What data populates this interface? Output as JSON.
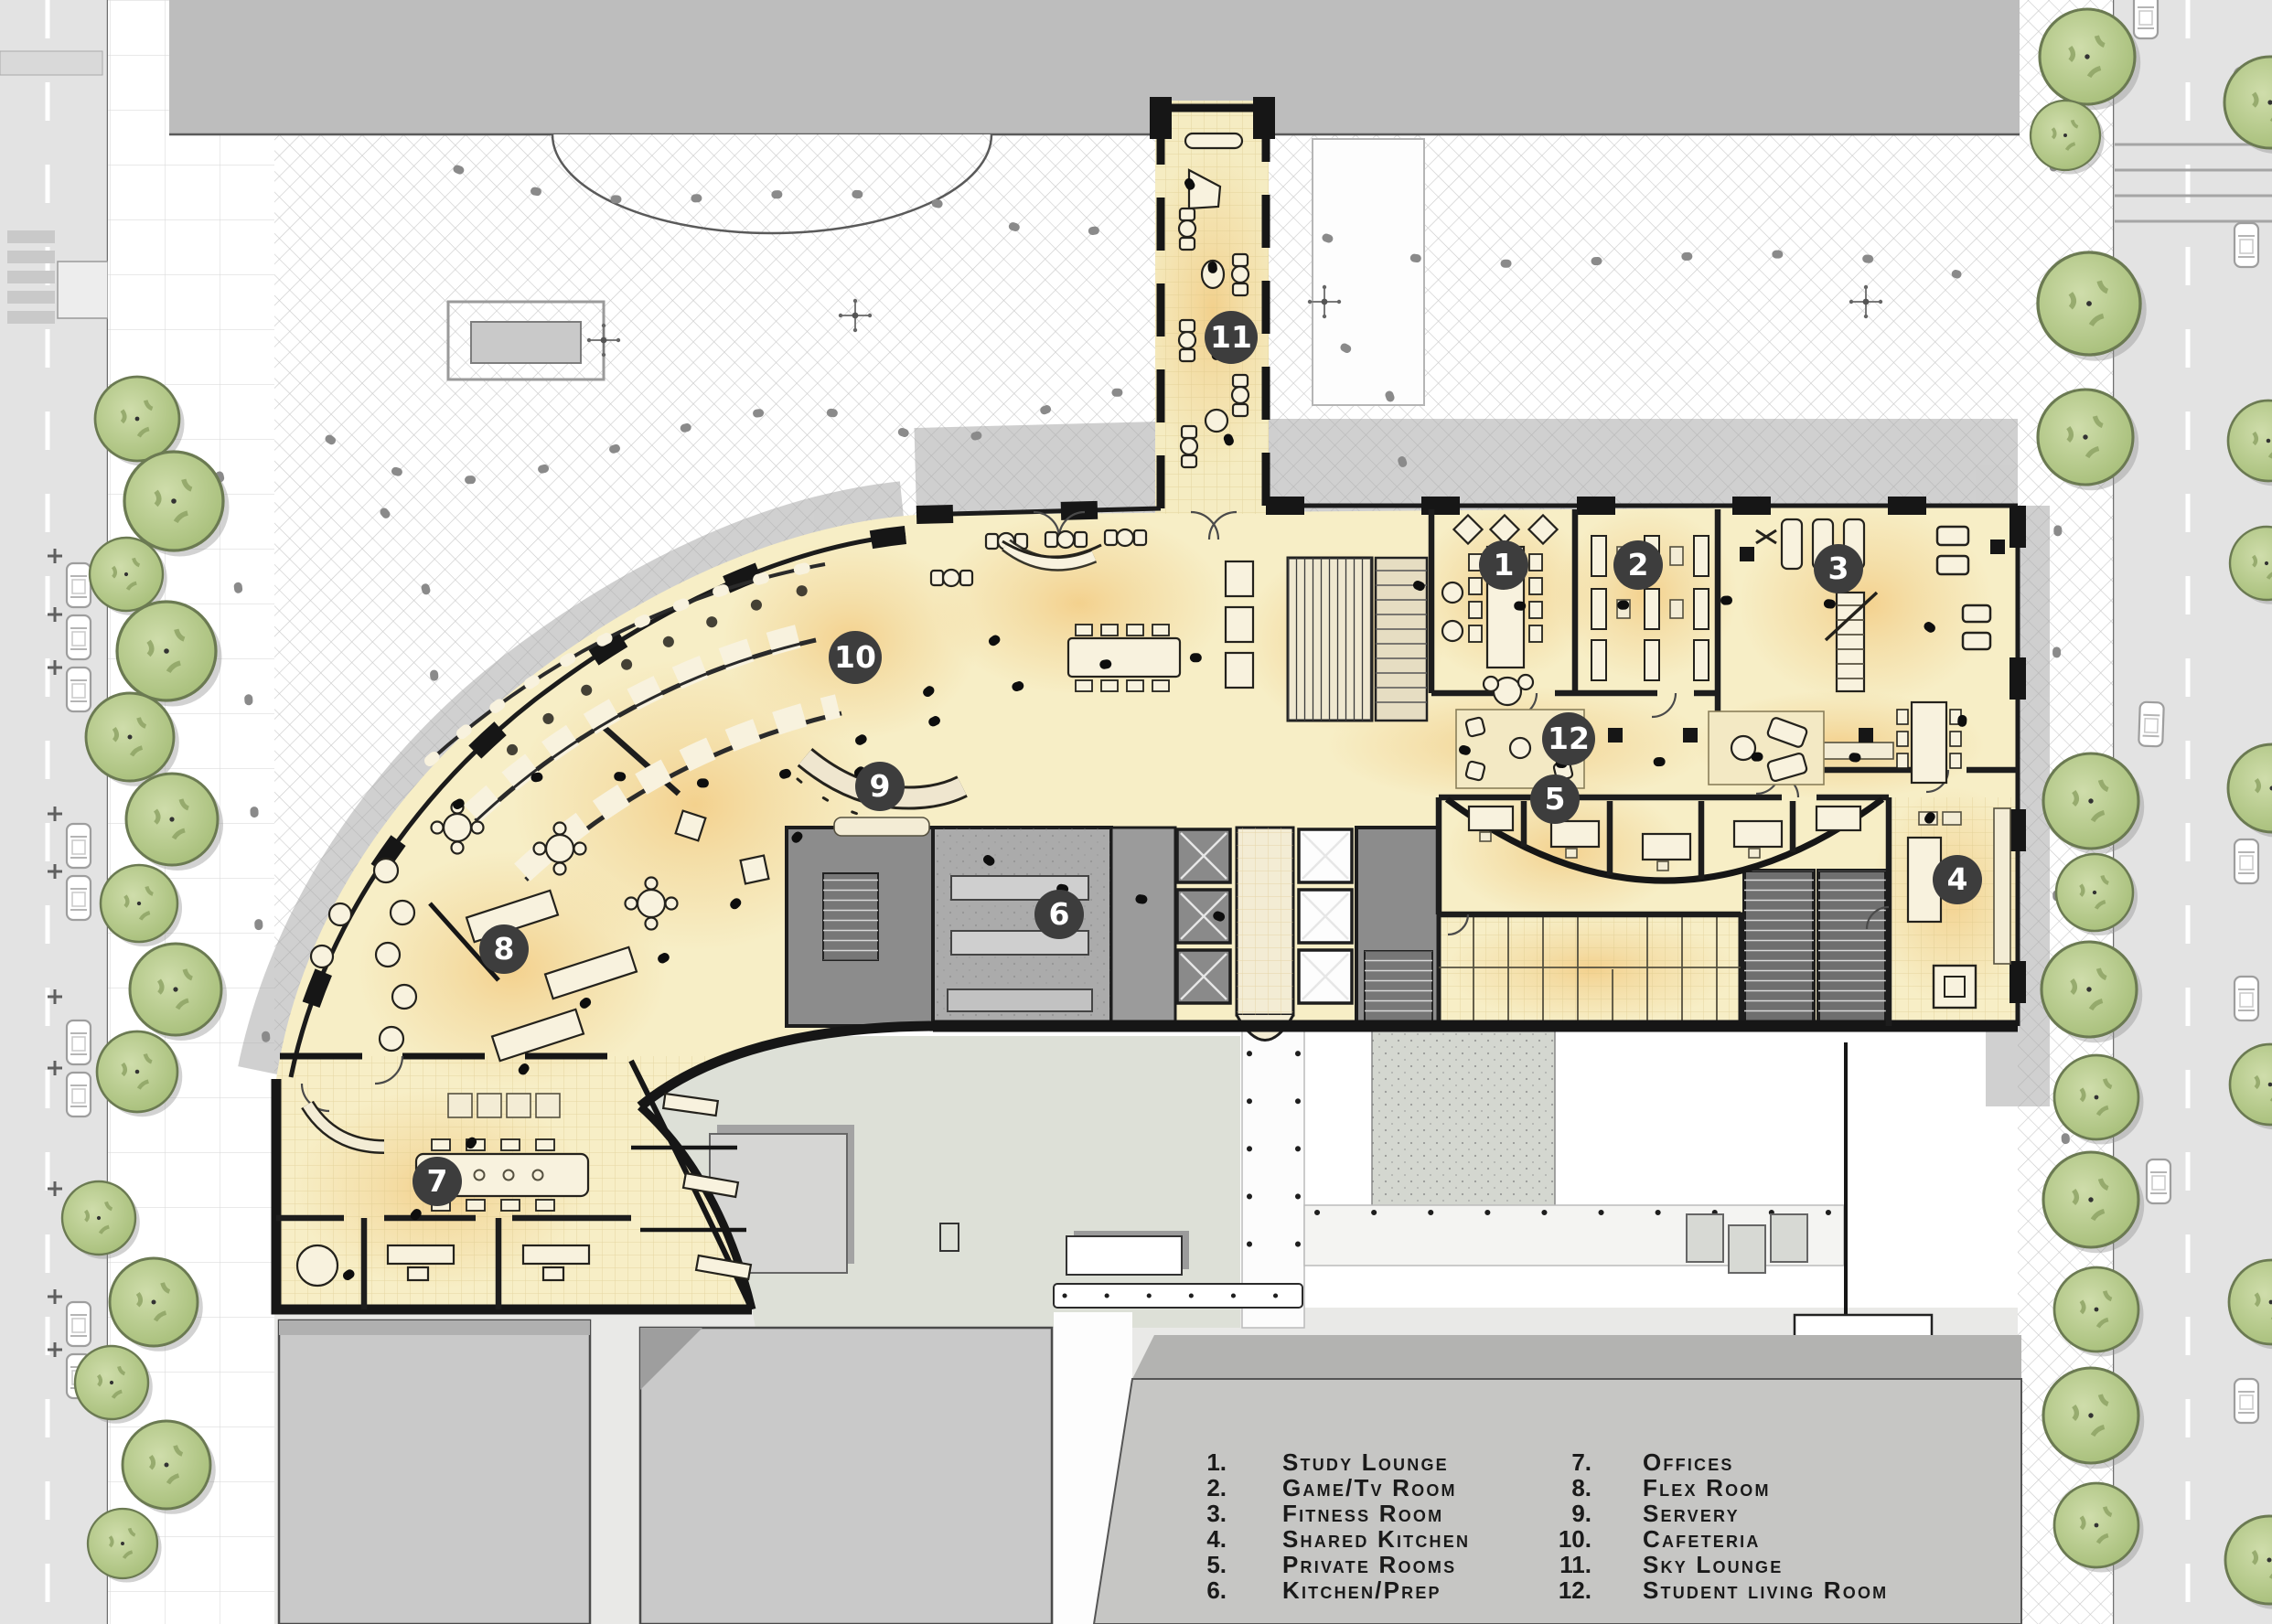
{
  "page": {
    "type": "architectural-ground-floor-site-plan",
    "building": "student residence podium",
    "title": ""
  },
  "legend": {
    "items": [
      {
        "num": "1.",
        "label": "Study Lounge"
      },
      {
        "num": "2.",
        "label": "Game/Tv Room"
      },
      {
        "num": "3.",
        "label": "Fitness Room"
      },
      {
        "num": "4.",
        "label": "Shared Kitchen"
      },
      {
        "num": "5.",
        "label": "Private Rooms"
      },
      {
        "num": "6.",
        "label": "Kitchen/Prep"
      },
      {
        "num": "7.",
        "label": "Offices"
      },
      {
        "num": "8.",
        "label": "Flex Room"
      },
      {
        "num": "9.",
        "label": "Servery"
      },
      {
        "num": "10.",
        "label": "Cafeteria"
      },
      {
        "num": "11.",
        "label": "Sky Lounge"
      },
      {
        "num": "12.",
        "label": "Student living Room"
      }
    ]
  },
  "markers": [
    {
      "num": "1",
      "label": "Study Lounge"
    },
    {
      "num": "2",
      "label": "Game/Tv Room"
    },
    {
      "num": "3",
      "label": "Fitness Room"
    },
    {
      "num": "4",
      "label": "Shared Kitchen"
    },
    {
      "num": "5",
      "label": "Private Rooms"
    },
    {
      "num": "6",
      "label": "Kitchen/Prep"
    },
    {
      "num": "7",
      "label": "Offices"
    },
    {
      "num": "8",
      "label": "Flex Room"
    },
    {
      "num": "9",
      "label": "Servery"
    },
    {
      "num": "10",
      "label": "Cafeteria"
    },
    {
      "num": "11",
      "label": "Sky Lounge"
    },
    {
      "num": "12",
      "label": "Student living Room"
    }
  ],
  "colors": {
    "floor_cream": "#f7eec6",
    "floor_glow_orange": "#f0b95f",
    "wall_black": "#161616",
    "road_gray": "#e3e3e3",
    "paving_gray": "#bdbdbd",
    "apron_gray": "#a9a9a9",
    "courtyard_green_gray": "#dde0d7",
    "building_roof_gray": "#c8c8c6",
    "tree_green": "#b9cc90",
    "tree_outline": "#6b7a52",
    "marker_circle": "#3d3d3d",
    "marker_text": "#ffffff",
    "legend_text": "#1a1a1a"
  },
  "icons": {
    "tree-icon": "scalloped canopy circle with trunk dot",
    "car-icon": "rounded rectangle with windshield lines",
    "parking-plus-icon": "plus cross at parking stall",
    "street-lamp-icon": "dot with four spokes",
    "person-dot-icon": "small dark figure blob",
    "elevator-x-icon": "square with diagonal cross",
    "stair-icon": "striped tread rectangle",
    "bollard-dot-icon": "small round dot row",
    "crosswalk-icon": "striped pedestrian bars",
    "door-swing-icon": "quarter-circle arc"
  }
}
